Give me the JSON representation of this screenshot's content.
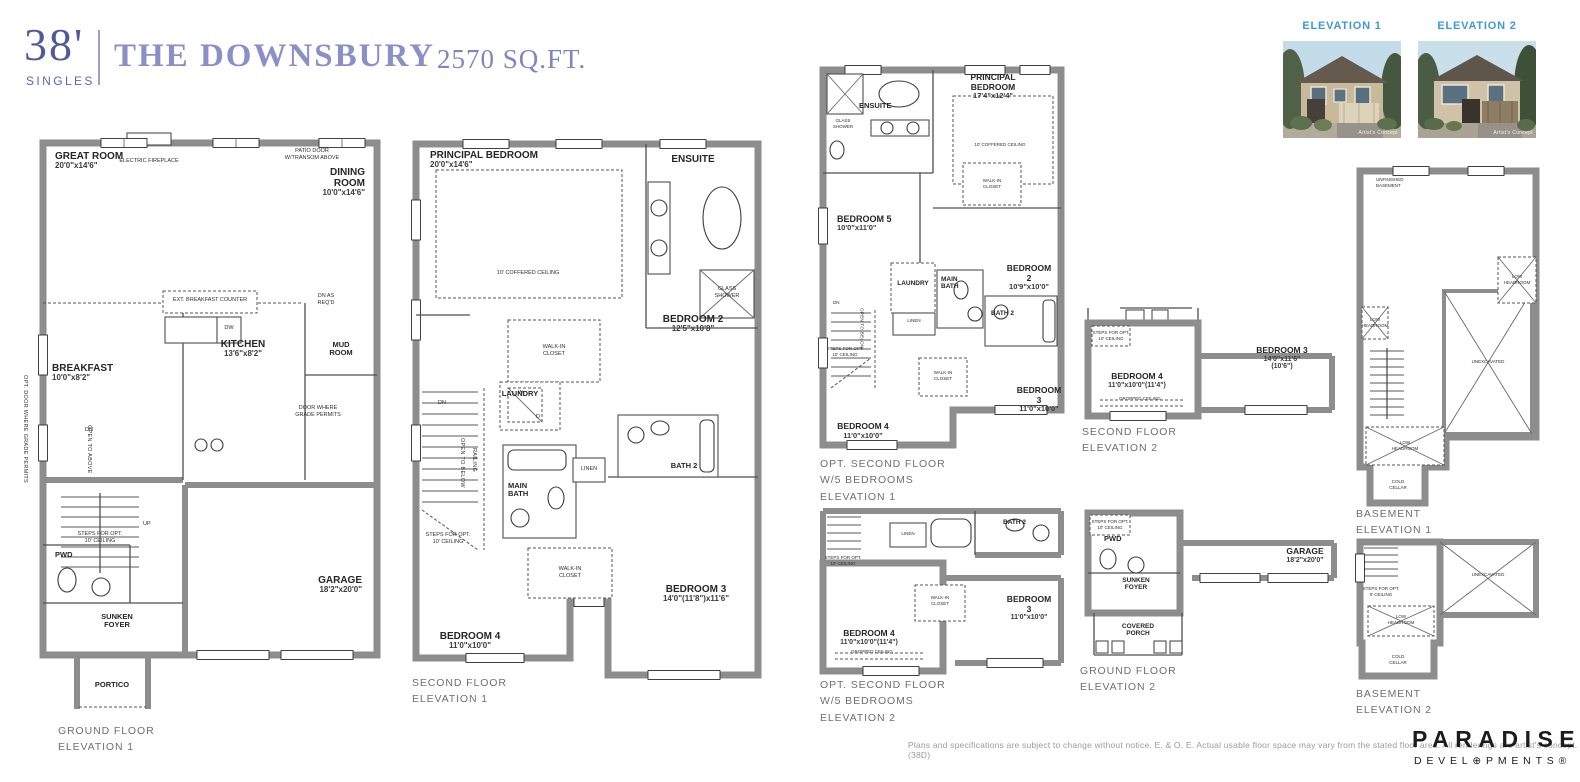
{
  "header": {
    "width": "38'",
    "type": "SINGLES",
    "name": "THE DOWNSBURY",
    "sqft": "2570 SQ.FT."
  },
  "renders": {
    "label1": "ELEVATION 1",
    "label2": "ELEVATION 2",
    "credit": "Artist's Concept"
  },
  "p1": {
    "caption": "GROUND FLOOR\nELEVATION 1",
    "rooms": {
      "great": {
        "n": "GREAT ROOM",
        "d": "20'0\"x14'6\""
      },
      "dining": {
        "n": "DINING ROOM",
        "d": "10'0\"x14'6\""
      },
      "kitchen": {
        "n": "KITCHEN",
        "d": "13'6\"x8'2\""
      },
      "breakfast": {
        "n": "BREAKFAST",
        "d": "10'0\"x8'2\""
      },
      "mud": {
        "n": "MUD\nROOM"
      },
      "pwd": {
        "n": "PWD"
      },
      "foyer": {
        "n": "SUNKEN\nFOYER"
      },
      "portico": {
        "n": "PORTICO"
      },
      "garage": {
        "n": "GARAGE",
        "d": "18'2\"x20'0\""
      }
    },
    "notes": {
      "fireplace": "ELECTRIC FIREPLACE",
      "patio": "PATIO DOOR\nW/TRANSOM ABOVE",
      "counter": "EXT. BREAKFAST COUNTER",
      "dw": "DW",
      "dnreq": "DN AS\nREQ'D",
      "doorgrade": "DOOR WHERE\nGRADE PERMITS",
      "optdoor": "OPT. DOOR WHERE GRADE PERMITS",
      "open": "OPEN TO ABOVE",
      "steps": "STEPS FOR OPT.\n10' CEILING",
      "up": "UP",
      "dn": "DN"
    }
  },
  "p2": {
    "caption": "SECOND FLOOR\nELEVATION 1",
    "rooms": {
      "principal": {
        "n": "PRINCIPAL BEDROOM",
        "d": "20'0\"x14'6\""
      },
      "ensuite": {
        "n": "ENSUITE"
      },
      "bed2": {
        "n": "BEDROOM 2",
        "d": "12'5\"x10'8\""
      },
      "bed3": {
        "n": "BEDROOM 3",
        "d": "14'0\"(11'8\")x11'6\""
      },
      "bed4": {
        "n": "BEDROOM 4",
        "d": "11'0\"x10'0\""
      },
      "laundry": {
        "n": "LAUNDRY"
      },
      "mainbath": {
        "n": "MAIN\nBATH"
      },
      "bath2": {
        "n": "BATH 2"
      }
    },
    "notes": {
      "coffered": "10' COFFERED CEILING",
      "glass": "GLASS\nSHOWER",
      "wic1": "WALK-IN\nCLOSET",
      "wic2": "WALK-IN\nCLOSET",
      "linen": "LINEN",
      "openbelow": "OPEN TO BELOW",
      "railing": "RAILING",
      "steps": "STEPS FOR OPT.\n10' CEILING",
      "dn": "DN",
      "w": "W",
      "dl": "D"
    }
  },
  "p3": {
    "caption": "OPT. SECOND FLOOR\nW/5 BEDROOMS\nELEVATION 1",
    "rooms": {
      "principal": {
        "n": "PRINCIPAL BEDROOM",
        "d": "17'4\"x12'4\""
      },
      "ensuite": {
        "n": "ENSUITE"
      },
      "bed5": {
        "n": "BEDROOM 5",
        "d": "10'0\"x11'0\""
      },
      "bed2": {
        "n": "BEDROOM 2",
        "d": "10'9\"x10'0\""
      },
      "bed3": {
        "n": "BEDROOM 3",
        "d": "11'0\"x10'0\""
      },
      "bed4": {
        "n": "BEDROOM 4",
        "d": "11'0\"x10'0\""
      },
      "laundry": {
        "n": "LAUNDRY"
      },
      "mainbath": {
        "n": "MAIN\nBATH"
      },
      "bath2": {
        "n": "BATH 2"
      }
    },
    "notes": {
      "coffered": "10' COFFERED CEILING",
      "glass": "GLASS\nSHOWER",
      "wic1": "WALK-IN\nCLOSET",
      "wic2": "WALK-IN\nCLOSET",
      "linen": "LINEN",
      "openbelow": "OPEN TO BELOW",
      "steps": "STEPS FOR OPT.\n10' CEILING",
      "dn": "DN"
    }
  },
  "p4": {
    "caption": "SECOND FLOOR\nELEVATION 2",
    "rooms": {
      "bed4": {
        "n": "BEDROOM 4",
        "d": "11'0\"x10'0\"(11'4\")"
      },
      "bed3": {
        "n": "BEDROOM 3",
        "d": "14'0\"x11'6\"(10'6\")"
      }
    },
    "notes": {
      "dropped": "DROPPED CEILING",
      "steps": "STEPS FOR OPT.\n10' CEILING"
    }
  },
  "p5": {
    "caption": "OPT. SECOND FLOOR\nW/5 BEDROOMS\nELEVATION 2",
    "rooms": {
      "bed4": {
        "n": "BEDROOM 4",
        "d": "11'0\"x10'0\"(11'4\")"
      },
      "bed3": {
        "n": "BEDROOM 3",
        "d": "11'0\"x10'0\""
      },
      "bath2": {
        "n": "BATH 2"
      }
    },
    "notes": {
      "linen": "LINEN",
      "wic": "WALK-IN\nCLOSET",
      "dropped": "DROPPED CEILING",
      "steps": "STEPS FOR OPT.\n10' CEILING"
    }
  },
  "p6": {
    "caption": "GROUND FLOOR\nELEVATION 2",
    "rooms": {
      "pwd": {
        "n": "PWD"
      },
      "foyer": {
        "n": "SUNKEN\nFOYER"
      },
      "porch": {
        "n": "COVERED\nPORCH"
      },
      "garage": {
        "n": "GARAGE",
        "d": "18'2\"x20'0\""
      }
    },
    "notes": {
      "steps": "STEPS FOR OPT.\n10' CEILING"
    }
  },
  "p7": {
    "caption": "BASEMENT\nELEVATION 1",
    "notes": {
      "unfinished": "UNFINISHED\nBASEMENT",
      "unex": "UNEXCAVATED",
      "low": "LOW\nHEADROOM",
      "cold": "COLD\nCELLAR"
    }
  },
  "p8": {
    "caption": "BASEMENT\nELEVATION 2",
    "notes": {
      "unex": "UNEXCAVATED",
      "low": "LOW\nHEADROOM",
      "cold": "COLD\nCELLAR",
      "steps": "STEPS FOR OPT.\n9' CEILING"
    }
  },
  "footer": {
    "disclaimer": "Plans and specifications are subject to change without notice. E. & O. E.  Actual usable floor space may vary from the stated floor area. All renderings are artist's concept. (38D)",
    "brand": "PARADISE",
    "brand_sub": "DEVEL⊕PMENTS®"
  }
}
